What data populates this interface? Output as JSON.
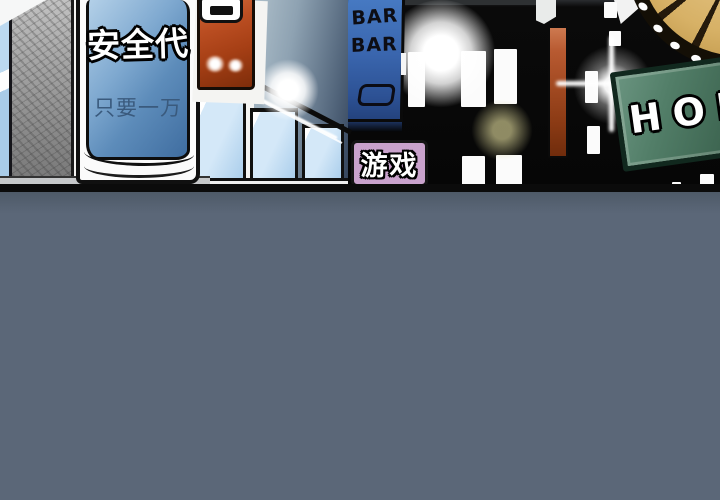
{
  "panel": {
    "description": "comic night street scene",
    "signs": {
      "safety": {
        "title": "安全代",
        "subtitle": "只要一万"
      },
      "bar": {
        "line1": "BAR",
        "line2": "BAR"
      },
      "game": {
        "label": "游戏"
      },
      "hof": {
        "label": "HOF"
      }
    },
    "colors": {
      "ground": "#5b6778",
      "night_sky": "#060606",
      "safety_sign_blue": "#6f9cc8",
      "orange_sign": "#b0451c",
      "bar_sign_blue": "#3a66ae",
      "game_sign_pink": "#c9a2cc",
      "hof_sign_green": "#4a7560",
      "maroon_banner": "#a34a22",
      "wheel_gold": "#d7b166",
      "window_glass": "#d4e8f8"
    }
  }
}
